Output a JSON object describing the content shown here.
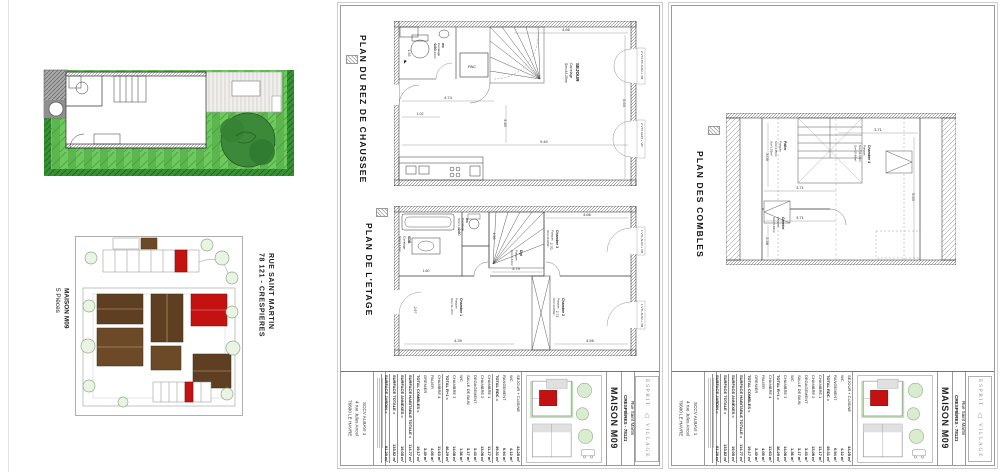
{
  "site": {
    "street": "RUE SAINT MARTIN",
    "city": "78 121  -  CRESPIERES",
    "house": "MAISON M09",
    "pieces": "5 Pièces"
  },
  "titles": {
    "rdc": "PLAN DU REZ DE CHAUSSEE",
    "etage": "PLAN DE L'ETAGE",
    "combles": "PLAN DES COMBLES"
  },
  "rdc": {
    "sejour": {
      "name": "SEJOUR",
      "floor": "Carrelage",
      "area": "Sm=44.25m²"
    },
    "wc": {
      "name": "WC",
      "floor": "Carrelage",
      "area": "Sm=4.12m²"
    },
    "pac": "PAC",
    "fridge": "F",
    "dims": {
      "top": "4.66",
      "mid": "4.74",
      "bottom": "9.40",
      "right": "5.53",
      "inner": "3.40",
      "small": "1.02",
      "wc_w": "2.80",
      "wc_h": "1.53"
    },
    "tags": {
      "a": "2 VTX PF AL03 + VR",
      "b": "2 VTX AL03 + VR"
    }
  },
  "etage": {
    "rooms": {
      "c1": {
        "name": "Chambre 1",
        "floor": "Parquet",
        "area": "Sm=11.17m²"
      },
      "c2": {
        "name": "Chambre 2",
        "floor": "Parquet",
        "area": "Sm=13.08m²"
      },
      "c3": {
        "name": "Chambre 3",
        "floor": "Parquet",
        "area": "Sm=14.08m²"
      },
      "sdb": {
        "name": "SDB",
        "floor": "Carrelage",
        "area": "Sm=3.17m²"
      },
      "wc": {
        "name": "WC",
        "floor": "Carrelage",
        "area": "Sm=1.36m²"
      },
      "dgt": {
        "name": "Dgt",
        "floor": "Parquet",
        "area": "Sm=3.43m²"
      }
    },
    "dims": {
      "top": "4.66",
      "c3v": "2.70",
      "corridor": "3.79",
      "sdb_d": "1.60",
      "wc_w": "1.56",
      "sdb_v": "2.80",
      "c1v": "2.67",
      "c1h": "4.39",
      "c2v": "2.74",
      "c2h": "4.56"
    },
    "tags": {
      "a": "1 VTL AL03 + VR",
      "b": "1 VTL AL03 + VR"
    }
  },
  "combles": {
    "rooms": {
      "c4": {
        "name": "Chambre 4",
        "floor": "Parquet",
        "area": "Sm=11.63m²",
        "su": "Su=10.46m²"
      },
      "palier": {
        "name": "Palier",
        "floor": "Parquet",
        "area": "Sm=4.05m²",
        "su": "Su=1.52m²"
      },
      "grenier": {
        "name": "Grenier",
        "floor": "parquet",
        "area": "Sm=3.49m²"
      }
    },
    "dims": {
      "top": "3.71",
      "mid": "3.71",
      "bottom": "3.71",
      "right": "5.53",
      "left": "3.09",
      "left2": "2.38"
    }
  },
  "titleblock": {
    "owner": [
      "SCCV ALBAVI 1",
      "4 rue Jules Ancel",
      "76600 LE HAVRE"
    ],
    "table": {
      "rdc": {
        "rows": [
          [
            "SEJOUR + CUISINE",
            "44.25 m²"
          ],
          [
            "WC",
            "4.12 m²"
          ],
          [
            "RANGEMENT",
            "0.94 m²"
          ]
        ],
        "total": [
          "TOTAL RDC =",
          "49.31 m²"
        ]
      },
      "etage": {
        "rows": [
          [
            "CHAMBRE 1",
            "11.17 m²"
          ],
          [
            "CHAMBRE 2",
            "13.08 m²"
          ],
          [
            "DEGAGEMENT",
            "3.43 m²"
          ],
          [
            "SALLE DE BAIN",
            "3.17 m²"
          ],
          [
            "WC",
            "1.36 m²"
          ],
          [
            "CHAMBRE 3",
            "14.08 m²"
          ]
        ],
        "total": [
          "TOTAL R+1 =",
          "46.29 m²"
        ]
      },
      "combles": {
        "rows": [
          [
            "CHAMBRE 4",
            "11.63 m²"
          ],
          [
            "PALIER",
            "4.05 m²"
          ],
          [
            "GRENIER",
            "3.49 m²"
          ]
        ],
        "total": [
          "TOTAL COMBLES =",
          "19.17 m²"
        ]
      },
      "summary": [
        [
          "SURFACE HABITABLE TOTALE =",
          "114.77 m²"
        ],
        [
          "SURFACE ANNEXES =",
          "19.05 m²"
        ],
        [
          "SURFACE TOTALE =",
          "133.82 m²"
        ],
        [
          "SURFACE JARDIN =",
          "81.20 m²"
        ]
      ]
    },
    "project": {
      "name": "MAISON M09",
      "street": "Rue Saint Martin",
      "city": "CRESPIÈRES - 78121"
    },
    "logo": {
      "l1": "ESPRIT",
      "l2": "VILLAGE"
    }
  },
  "colors": {
    "lawn": "#5cb54e",
    "hedge": "#379134",
    "roof": "#5f3f21",
    "roof2": "#6d4a27",
    "highlight": "#c41111",
    "tree": "#3c8a39"
  }
}
